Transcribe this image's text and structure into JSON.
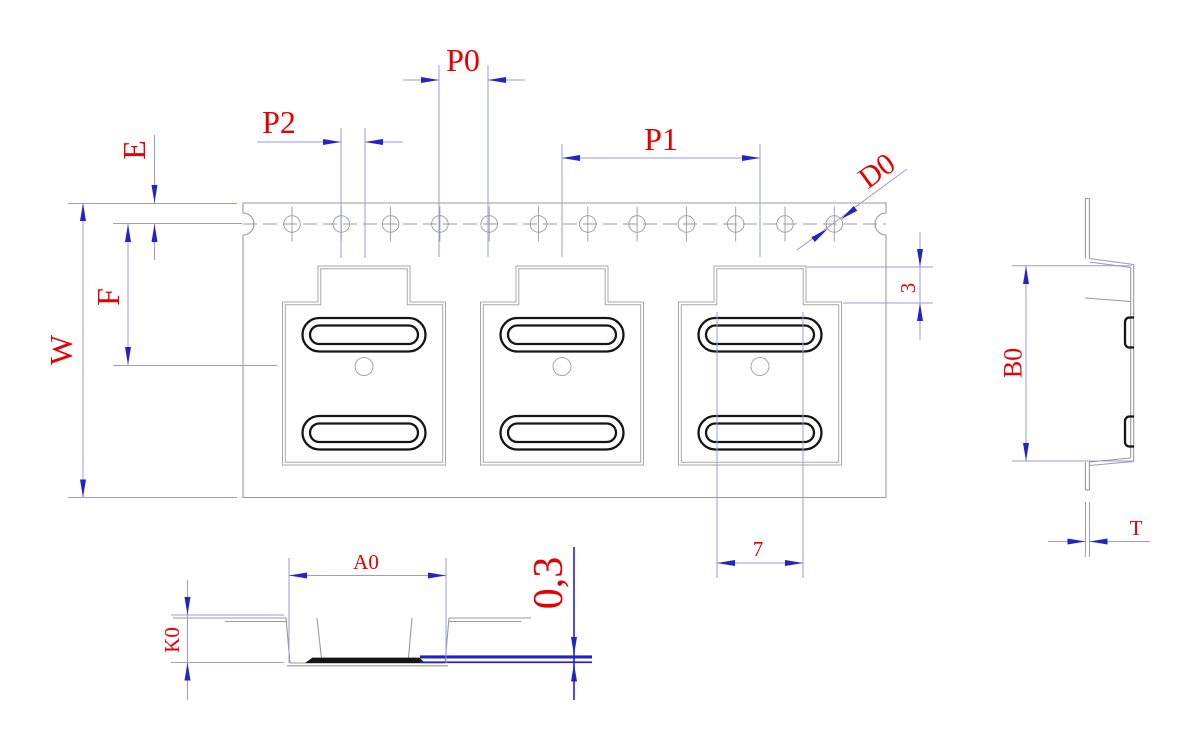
{
  "drawing": {
    "type": "carrier-tape-packaging-dimension-drawing",
    "labels": {
      "p0": "P0",
      "p2": "P2",
      "p1": "P1",
      "e": "E",
      "f": "F",
      "w": "W",
      "d0": "D0",
      "step_height": "3",
      "pad_length": "7",
      "b0": "B0",
      "t": "T",
      "a0": "A0",
      "k0": "K0",
      "cover_tape_thickness": "0,3"
    },
    "counts": {
      "sprocket_holes": 12,
      "edge_half_notches": 2,
      "pockets": 3,
      "pads_per_pocket": 2
    },
    "colors": {
      "label_red": "#e60000",
      "dimension_blue": "#2323c8",
      "extension_blue": "#9a9ade",
      "outline_gray": "#9a9a9a",
      "feature_black": "#151515",
      "cover_tape_blue": "#2222cc",
      "background": "#ffffff"
    }
  }
}
